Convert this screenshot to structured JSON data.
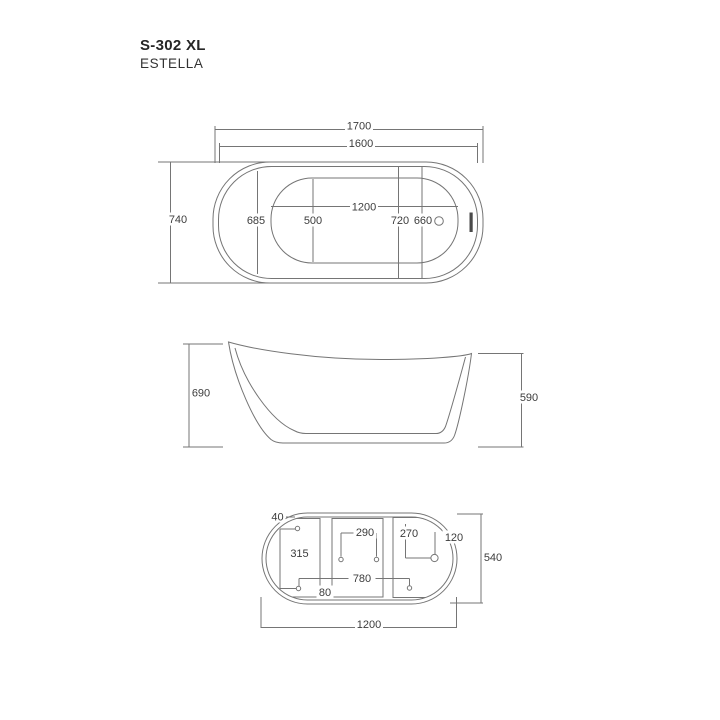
{
  "title": {
    "model": "S-302 XL",
    "series": "ESTELLA"
  },
  "colors": {
    "line": "#757575",
    "text": "#3c3c3c",
    "title": "#262626",
    "overflow_slot": "#4a4a4a",
    "background": "#ffffff"
  },
  "top_view": {
    "overall_length": "1700",
    "rim_length": "1600",
    "overall_width": "740",
    "rim_width": "685",
    "basin_width": "500",
    "basin_length": "1200",
    "dim_720": "720",
    "dim_660": "660"
  },
  "side_view": {
    "height_rear": "690",
    "height_front": "590"
  },
  "bottom_view": {
    "dim_40": "40",
    "dim_315": "315",
    "dim_290": "290",
    "dim_270": "270",
    "dim_120": "120",
    "base_width": "540",
    "dim_780": "780",
    "dim_80": "80",
    "base_length": "1200"
  }
}
